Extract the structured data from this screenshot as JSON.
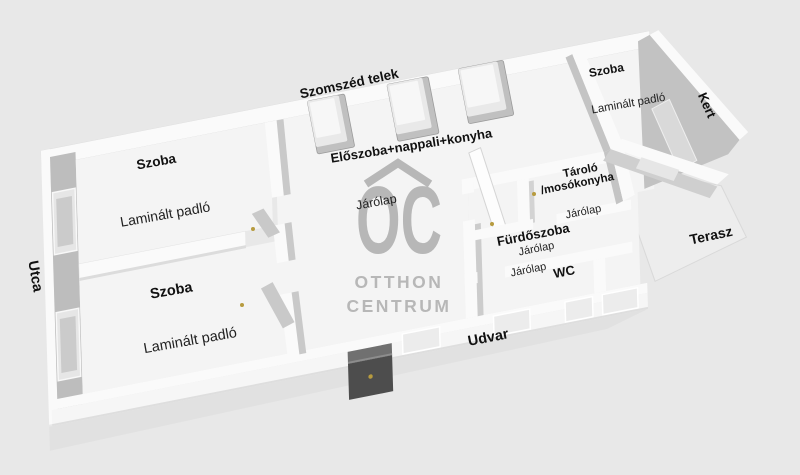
{
  "colors": {
    "background": "#e8e8e8",
    "floor": "#f4f4f4",
    "wall_top": "#fafafa",
    "wall_face": "#bdbdbd",
    "window_pane": "#cbcbcb",
    "terrace_floor": "#ededed",
    "furniture_dark": "#4d4d4d",
    "handle_gold": "#b79b3f",
    "watermark": "#b7b7b7",
    "label": "#111111"
  },
  "watermark": {
    "logo": "OC",
    "line1": "OTTHON",
    "line2": "CENTRUM"
  },
  "outside": {
    "neighbor_plot": "Szomszéd telek",
    "street": "Utca",
    "garden": "Kert",
    "terrace": "Terasz",
    "yard": "Udvar"
  },
  "rooms": {
    "room_top_left": {
      "name": "Szoba",
      "floor": "Laminált padló"
    },
    "room_bottom_left": {
      "name": "Szoba",
      "floor": "Laminált padló"
    },
    "living": {
      "name": "Előszoba+nappali+konyha",
      "floor": "Járólap"
    },
    "storage": {
      "name_line1": "Tároló",
      "name_line2": "/mosókonyha",
      "floor": "Járólap"
    },
    "bathroom": {
      "name": "Fürdőszoba",
      "floor": "Járólap"
    },
    "wc": {
      "name": "WC",
      "floor": "Járólap"
    },
    "room_right": {
      "name": "Szoba",
      "floor": "Laminált padló"
    }
  }
}
